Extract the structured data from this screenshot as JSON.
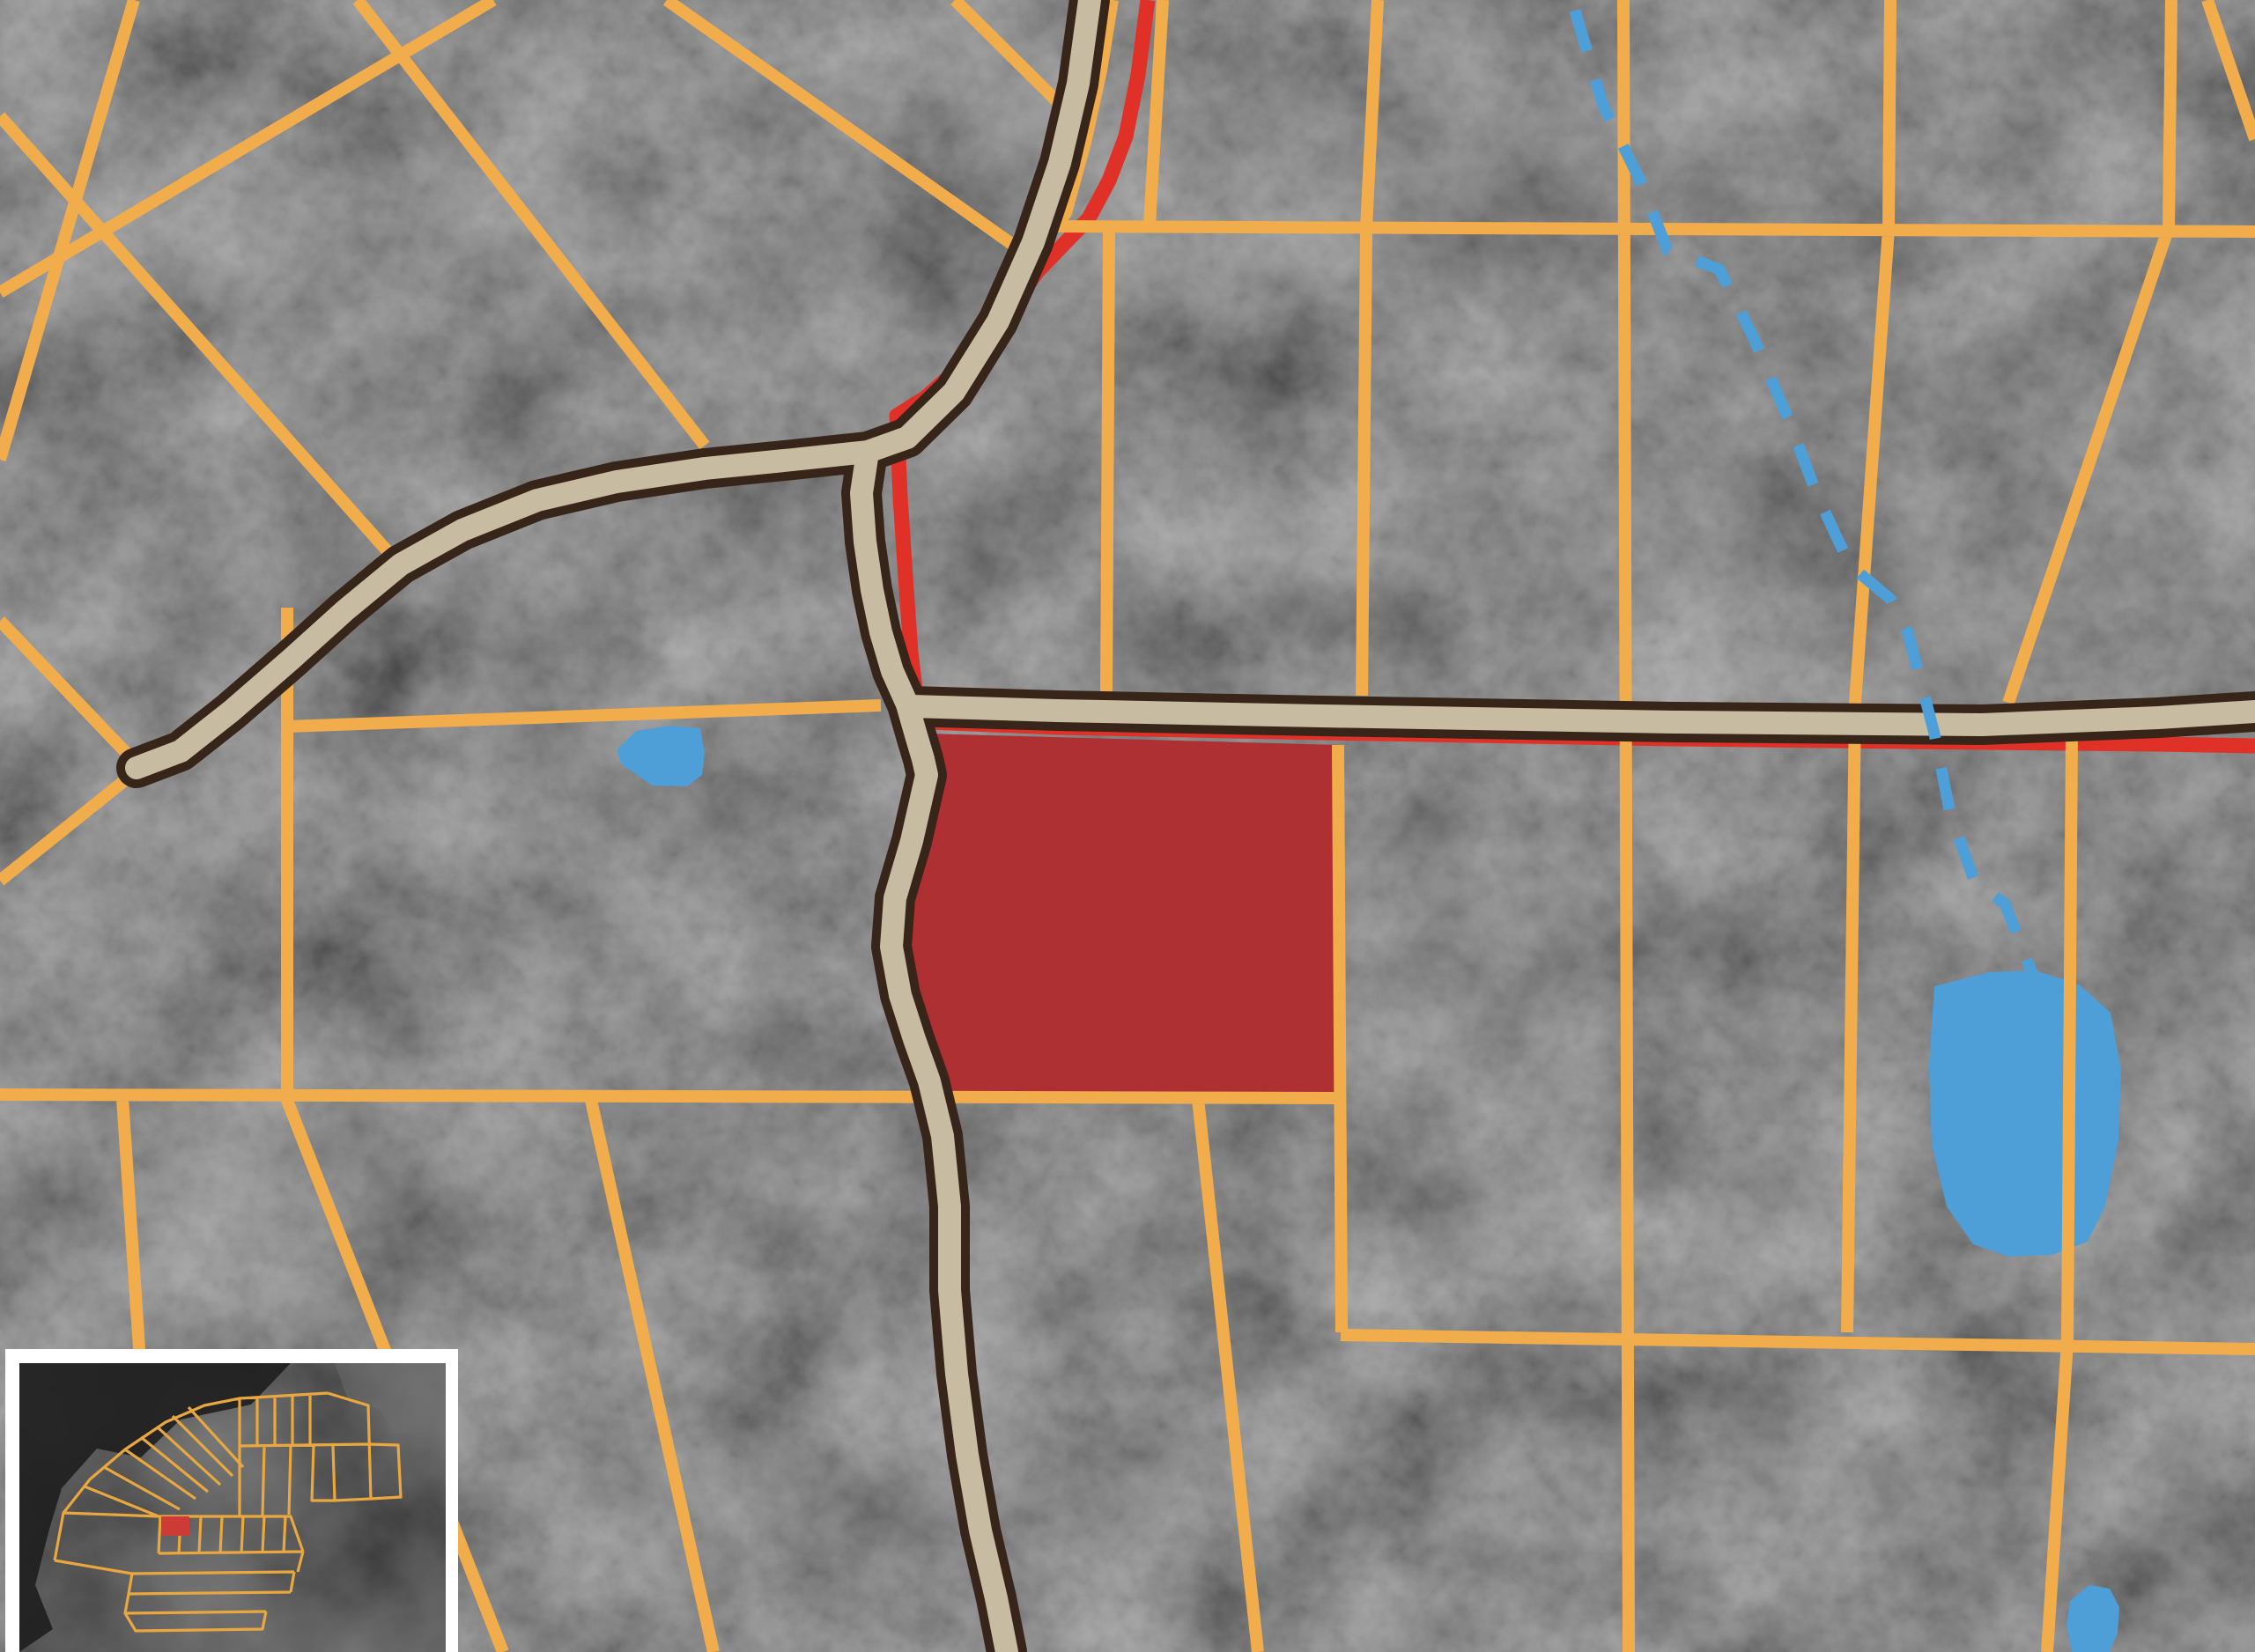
{
  "app": {
    "name": "parcel-map-viewer",
    "view": "satellite-grayscale-aerial-with-plat-overlay"
  },
  "map": {
    "colors": {
      "terrain": "#414141",
      "terrain_dark": "#2e2e2e",
      "terrain_light": "#a3a3a3",
      "parcel_line": "#F1AD4C",
      "road_fill": "#C7BCA1",
      "road_casing": "#38251A",
      "boundary_line": "#E03128",
      "subject_parcel": "#AF3032",
      "water": "#4E9ED7",
      "inset_border": "#FFFFFF",
      "inset_bg": "#2E2E2E",
      "inset_water": "#1E1E1E",
      "inset_field": "#6E6E6E",
      "inset_line": "#E9A83F",
      "inset_highlight": "#CC3B35"
    },
    "legend": {
      "parcel_boundary_lines": "orange",
      "road": "tan with dark brown casing",
      "survey_boundary": "red line",
      "subject_parcel": "solid red fill",
      "stream": "blue dashed",
      "water_bodies": "blue fill"
    },
    "features": {
      "roads": [
        "main-road",
        "east-road",
        "west-spur-road"
      ],
      "highlighted_parcel": 1,
      "water_bodies": [
        "small-pond-west",
        "lake-east",
        "pond-bottom-edge"
      ],
      "stream_style": "dashed",
      "stream_dash": "48 34",
      "text_labels": []
    },
    "inset": {
      "position": "bottom-left",
      "content": "overview plat map with subject parcel highlighted",
      "highlighted_parcel": 1
    }
  }
}
